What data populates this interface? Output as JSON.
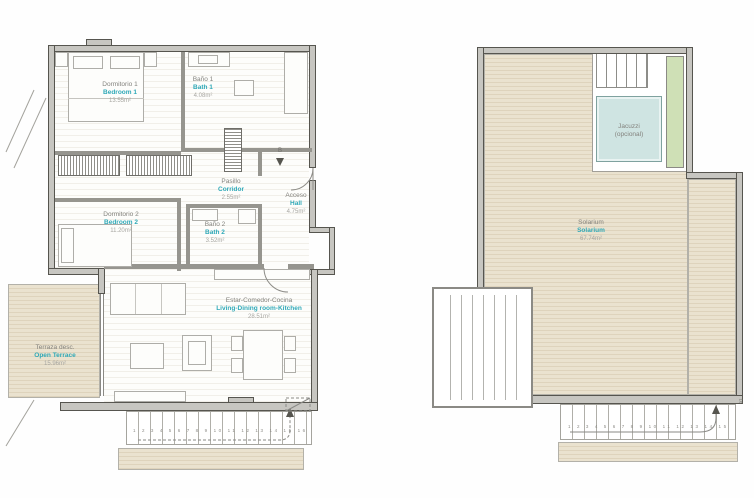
{
  "palette": {
    "accent_teal": "#2fa9b8",
    "label_gray": "#83827d",
    "area_gray": "#a7a6a1",
    "wall_fill": "#c7c6c1",
    "wall_line": "#56554f",
    "deck_beige": "#e8e0cd",
    "jacuzzi_blue": "#cfe4e2",
    "planter_green": "#cfe0b6"
  },
  "left_plan": {
    "rooms": {
      "bedroom1": {
        "es": "Dormitorio 1",
        "en": "Bedroom 1",
        "area": "13.55m²"
      },
      "bath1": {
        "es": "Baño 1",
        "en": "Bath 1",
        "area": "4.08m²"
      },
      "corridor": {
        "es": "Pasillo",
        "en": "Corridor",
        "area": "2.55m²"
      },
      "hall": {
        "es": "Acceso",
        "en": "Hall",
        "area": "4.75m²"
      },
      "bedroom2": {
        "es": "Dormitorio 2",
        "en": "Bedroom 2",
        "area": "11.20m²"
      },
      "bath2": {
        "es": "Baño 2",
        "en": "Bath 2",
        "area": "3.52m²"
      },
      "living": {
        "es": "Estar-Comedor-Cocina",
        "en": "Living-Dining room-Kitchen",
        "area": "28.51m²"
      },
      "terrace": {
        "es": "Terraza desc.",
        "en": "Open Terrace",
        "area": "15.96m²"
      }
    },
    "entry_marker": "B",
    "stairs_numbers": "1 2 3 4 5 6 7 8 9 10 11 12 13 14 15 16"
  },
  "right_plan": {
    "rooms": {
      "solarium": {
        "es": "Solarium",
        "en": "Solarium",
        "area": "67.74m²"
      },
      "jacuzzi": {
        "line1": "Jacuzzi",
        "line2": "(opcional)"
      }
    },
    "stairs_numbers": "1 2 3 4 5 6 7 8 9 10 11 12 13 14 15",
    "top_step_label": "16"
  }
}
